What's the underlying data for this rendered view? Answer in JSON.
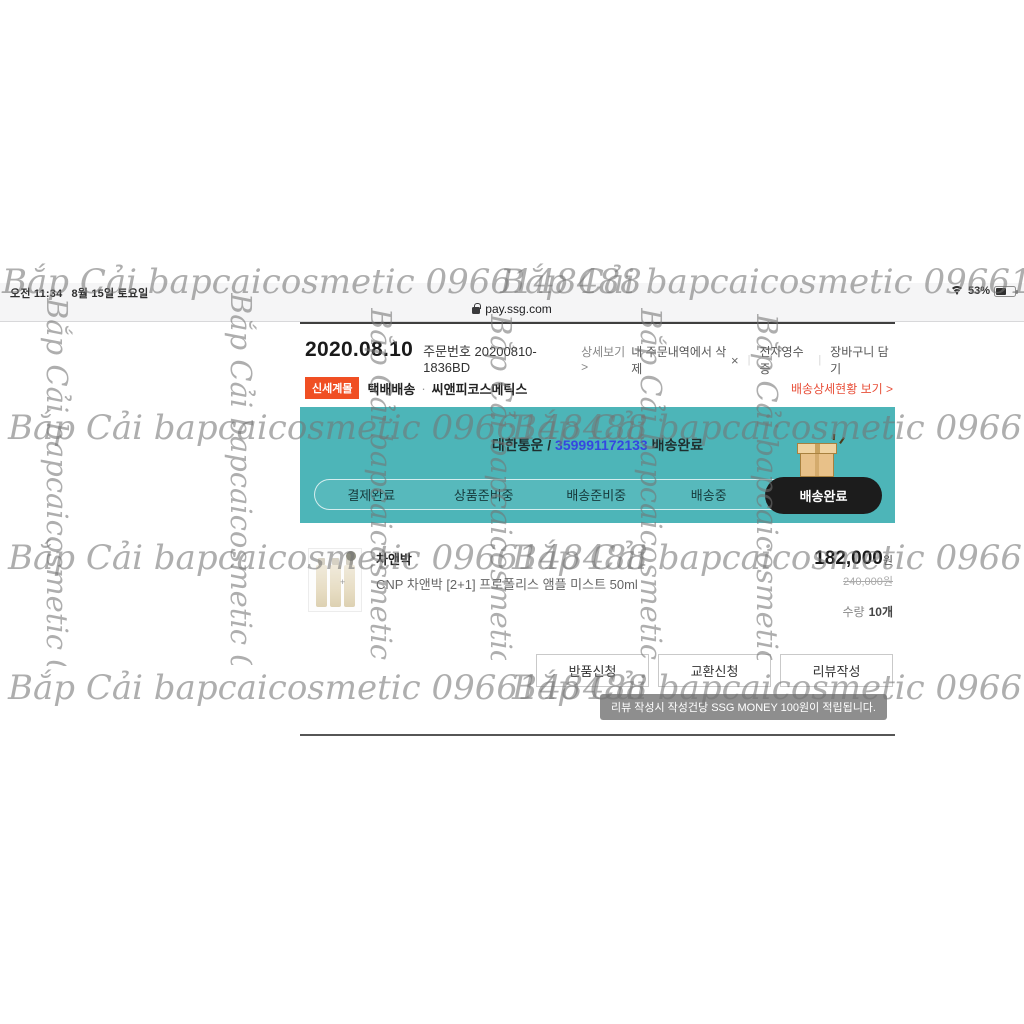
{
  "status_bar": {
    "time": "오전 11:34",
    "date": "8월 15일 토요일",
    "battery_percent": "53%"
  },
  "browser": {
    "url": "pay.ssg.com"
  },
  "order": {
    "date": "2020.08.10",
    "order_no": "주문번호 20200810-1836BD",
    "detail_link": "상세보기 >",
    "links": {
      "delete": "내 주문내역에서 삭제",
      "delete_x": "×",
      "receipt": "전자영수증",
      "cart": "장바구니 담기",
      "divider": "|"
    },
    "seller": {
      "badge": "신세계몰",
      "shipping_type": "택배배송",
      "dot": "·",
      "name": "씨앤피코스메틱스",
      "delivery_detail_link": "배송상세현황 보기 >"
    },
    "delivery": {
      "carrier": "대한통운 /",
      "tracking_no": "359991172133",
      "status_suffix": "배송완료",
      "steps": [
        "결제완료",
        "상품준비중",
        "배송준비중",
        "배송중"
      ],
      "current_step": "배송완료"
    },
    "product": {
      "brand": "차앤박",
      "name": "CNP 차앤박 [2+1] 프로폴리스 앰플 미스트 50ml",
      "price": "182,000",
      "price_unit": "원",
      "original_price": "240,000원",
      "qty_label": "수량",
      "qty": "10개",
      "plus": "+"
    },
    "actions": {
      "return": "반품신청",
      "exchange": "교환신청",
      "review": "리뷰작성"
    },
    "tooltip": "리뷰 작성시 작성건당 SSG MONEY 100원이 적립됩니다."
  },
  "watermark": {
    "text": "Bắp Cải bapcaicosmetic 0966148488"
  },
  "colors": {
    "banner_teal": "#4db5b8",
    "badge_orange": "#f04f23",
    "link_red": "#e8503a",
    "tracking_blue": "#3547e0",
    "final_pill_dark": "#1c1c1c"
  }
}
